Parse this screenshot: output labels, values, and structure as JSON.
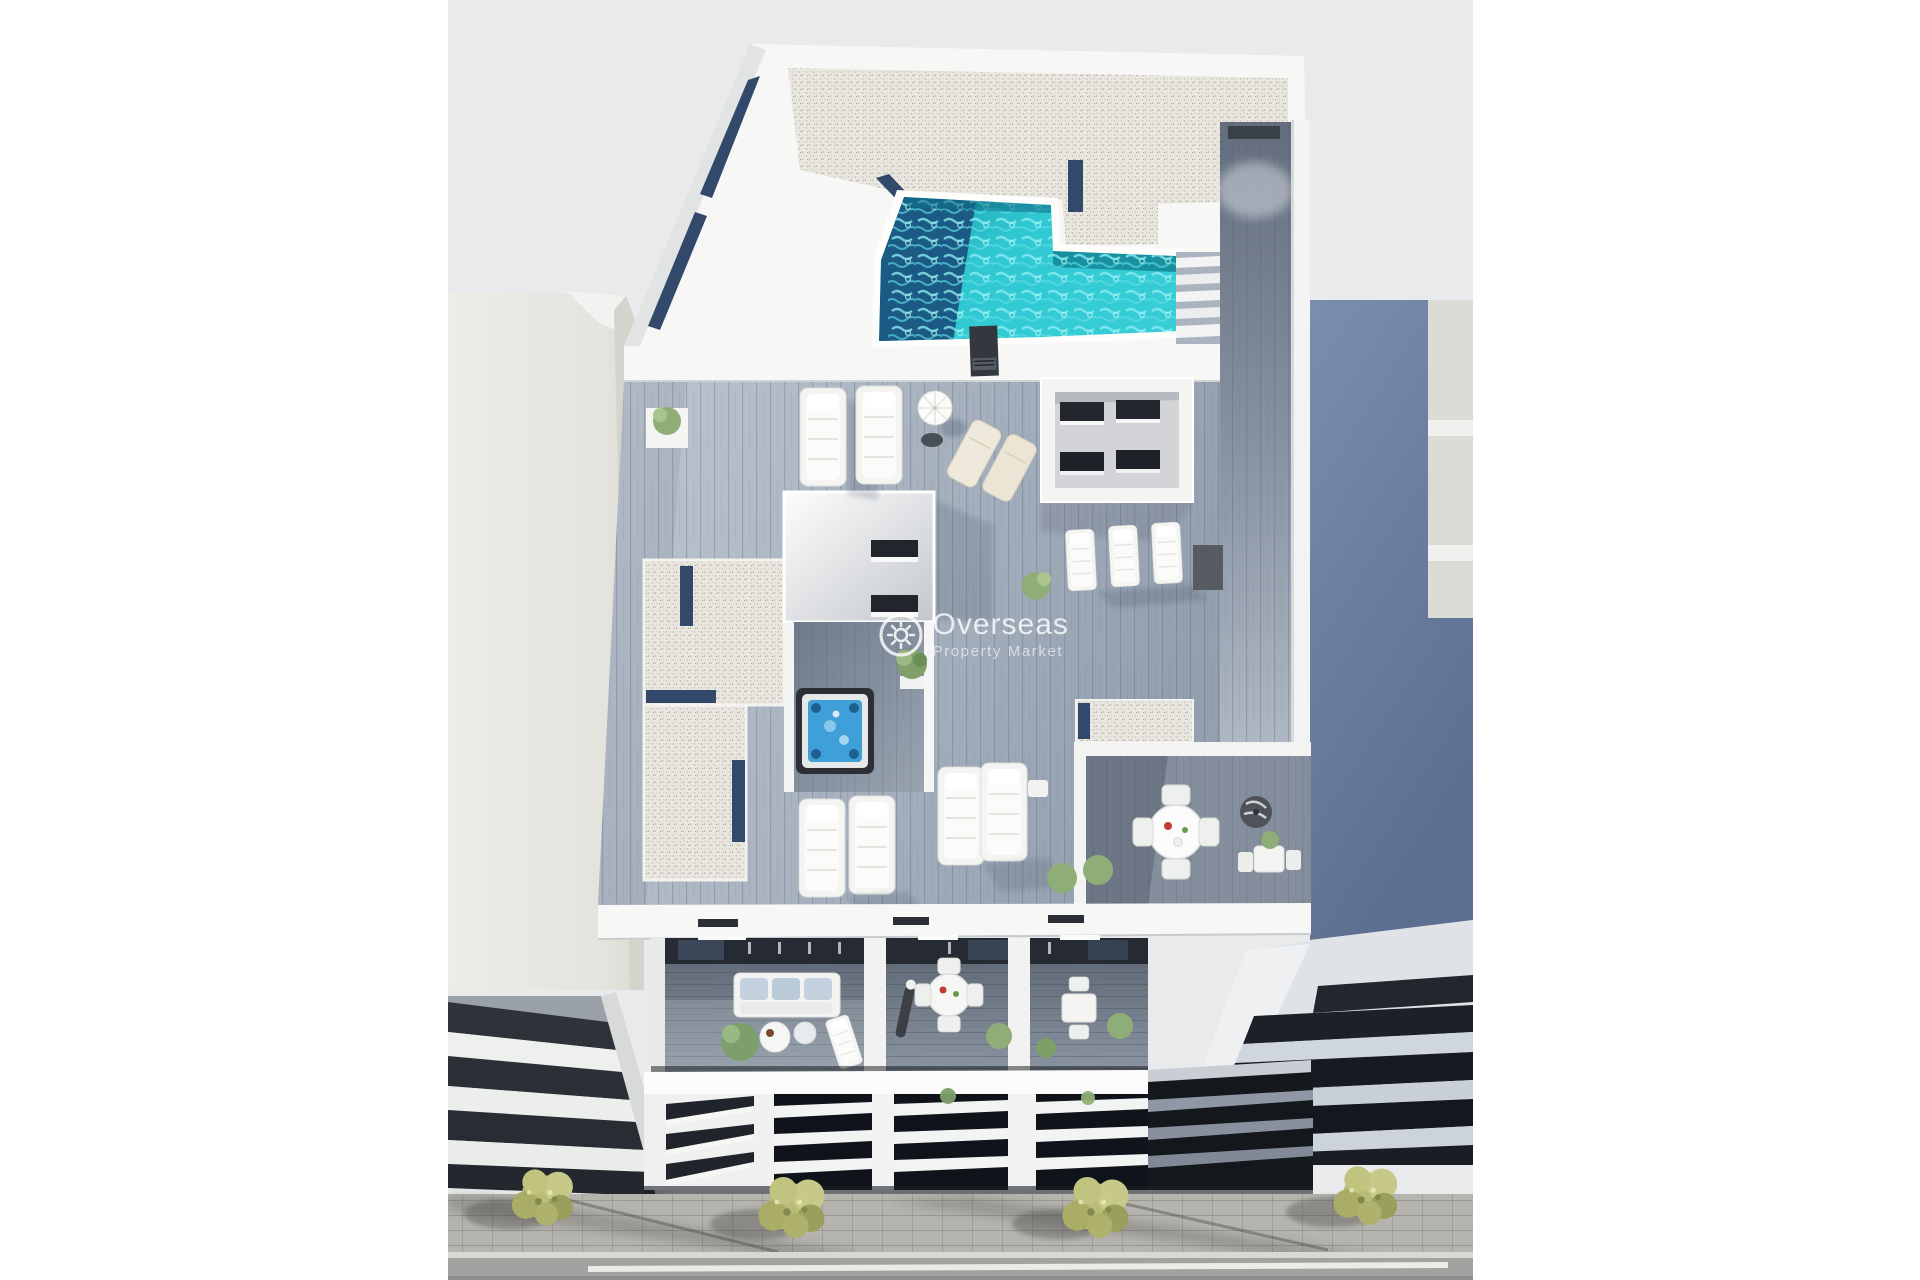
{
  "meta": {
    "kind": "architectural-3d-render",
    "view": "aerial",
    "subject": "new-build apartment block with rooftop pool, solarium terraces and balconies"
  },
  "watermark": {
    "title": "Overseas",
    "subtitle": "Property Market",
    "icon": "sun-icon"
  },
  "palette": {
    "backdrop": "#e9eaec",
    "page_bg": "#ffffff",
    "pool_water": "#2fc8d2",
    "pool_deep": "#1a5a84",
    "pool_teal": "#14899a",
    "pool_ripple": "#8feef2",
    "jacuzzi_water": "#3f9fd8",
    "gravel": "#e9e7e0",
    "gravel_channel": "#33496b",
    "deck_light": "#c6cdd6",
    "deck_mid": "#a6b0bd",
    "deck_dark": "#6e7989",
    "wall_white": "#f7f8f6",
    "wall_shade": "#cdd2d7",
    "left_wall": "#e8e7e2",
    "right_wall_top": "#7b8db0",
    "right_wall_bottom": "#5c6f90",
    "louver_dark": "#10141a",
    "slat_light": "#f2f4f4",
    "tree_olive": "#b8bc74",
    "sidewalk": "#b6b4af",
    "road": "#a3a2a0"
  },
  "scene": {
    "elements": [
      "rooftop-pool",
      "pool-stairs",
      "wood-walkway",
      "roof-gravel",
      "stairwell-box",
      "lightwell",
      "jacuzzi",
      "sun-loungers",
      "parasol",
      "dining-set",
      "balcony-terraces",
      "louvered-facade",
      "neighbor-building-left",
      "neighbor-building-right",
      "sidewalk",
      "street",
      "trees"
    ]
  }
}
